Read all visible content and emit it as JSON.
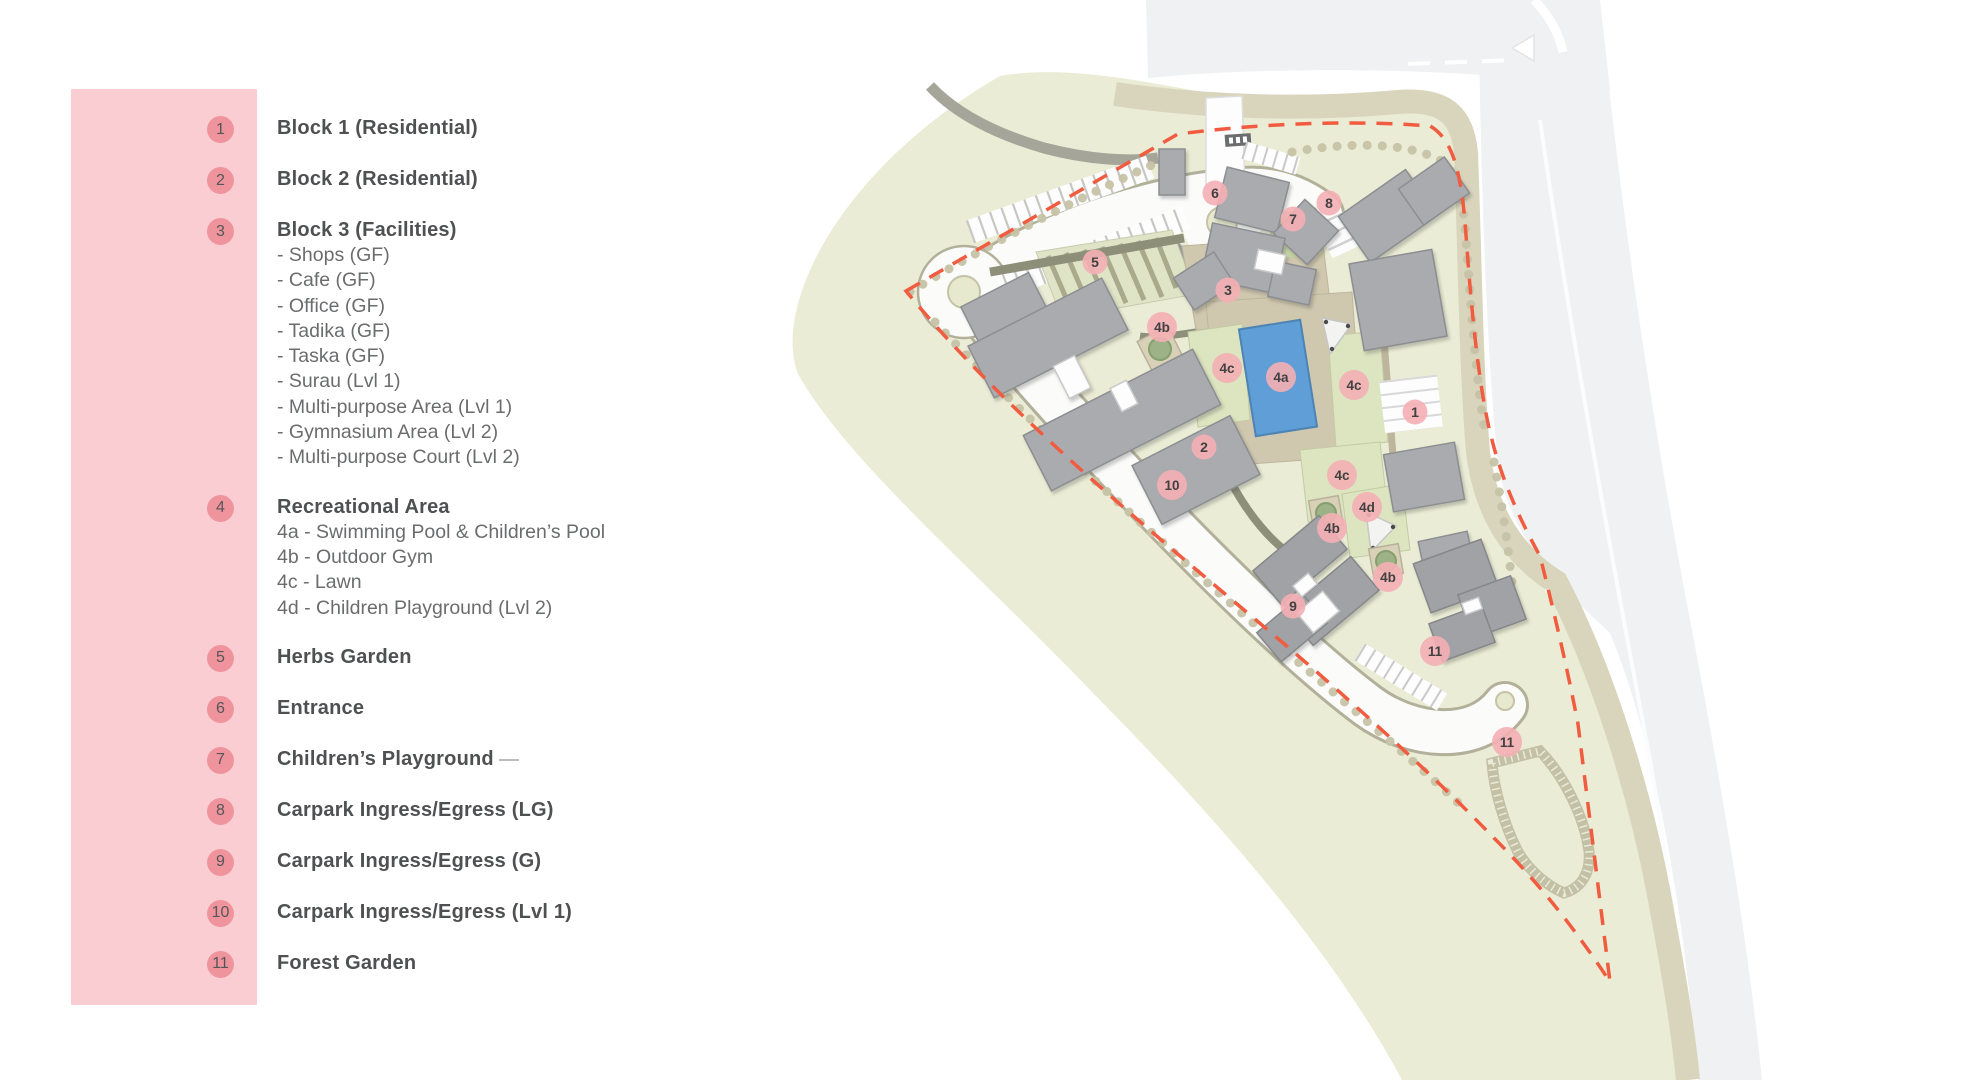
{
  "legend": {
    "items": [
      {
        "num": "1",
        "title": "Block 1 (Residential)",
        "subs": []
      },
      {
        "num": "2",
        "title": "Block 2 (Residential)",
        "subs": []
      },
      {
        "num": "3",
        "title": "Block 3 (Facilities)",
        "subs": [
          "- Shops (GF)",
          "- Cafe (GF)",
          "- Office (GF)",
          "- Tadika (GF)",
          "- Taska (GF)",
          "- Surau (Lvl 1)",
          "- Multi-purpose Area (Lvl 1)",
          "- Gymnasium Area (Lvl 2)",
          "- Multi-purpose Court (Lvl 2)"
        ]
      },
      {
        "num": "4",
        "title": "Recreational Area",
        "subs": [
          "4a - Swimming Pool & Children’s Pool",
          "4b - Outdoor Gym",
          "4c - Lawn",
          "4d - Children Playground (Lvl 2)"
        ]
      },
      {
        "num": "5",
        "title": "Herbs Garden",
        "subs": []
      },
      {
        "num": "6",
        "title": "Entrance",
        "subs": [],
        "trailing_dash": false
      },
      {
        "num": "7",
        "title": "Children’s Playground",
        "subs": [],
        "trailing_dash": true
      },
      {
        "num": "8",
        "title": "Carpark Ingress/Egress (LG)",
        "subs": []
      },
      {
        "num": "9",
        "title": "Carpark Ingress/Egress (G)",
        "subs": []
      },
      {
        "num": "10",
        "title": "Carpark Ingress/Egress (Lvl 1)",
        "subs": []
      },
      {
        "num": "11",
        "title": "Forest Garden",
        "subs": []
      }
    ]
  },
  "map": {
    "markers": [
      {
        "label": "6",
        "x": 1215,
        "y": 193
      },
      {
        "label": "8",
        "x": 1329,
        "y": 203
      },
      {
        "label": "7",
        "x": 1293,
        "y": 219
      },
      {
        "label": "5",
        "x": 1095,
        "y": 262
      },
      {
        "label": "3",
        "x": 1228,
        "y": 290
      },
      {
        "label": "4b",
        "x": 1162,
        "y": 327
      },
      {
        "label": "4c",
        "x": 1227,
        "y": 368
      },
      {
        "label": "4a",
        "x": 1281,
        "y": 377
      },
      {
        "label": "4c",
        "x": 1354,
        "y": 385
      },
      {
        "label": "1",
        "x": 1415,
        "y": 412
      },
      {
        "label": "2",
        "x": 1204,
        "y": 447
      },
      {
        "label": "4c",
        "x": 1342,
        "y": 475
      },
      {
        "label": "10",
        "x": 1172,
        "y": 485
      },
      {
        "label": "4d",
        "x": 1367,
        "y": 507
      },
      {
        "label": "4b",
        "x": 1332,
        "y": 528
      },
      {
        "label": "4b",
        "x": 1388,
        "y": 577
      },
      {
        "label": "9",
        "x": 1293,
        "y": 606
      },
      {
        "label": "11",
        "x": 1435,
        "y": 651
      },
      {
        "label": "11",
        "x": 1507,
        "y": 742
      }
    ]
  },
  "colors": {
    "panel": "#f9cdd1",
    "legend_circle": "#ef949c",
    "legend_text": "#4f5052",
    "marker": "#f4afb4",
    "marker_text": "#414142",
    "boundary": "#f15b40",
    "pool": "#5f9ed6",
    "landscape": "#eaecd5",
    "lawn": "#dce4c0",
    "building": "#a9abae",
    "road_tan": "#d9d5bd"
  }
}
